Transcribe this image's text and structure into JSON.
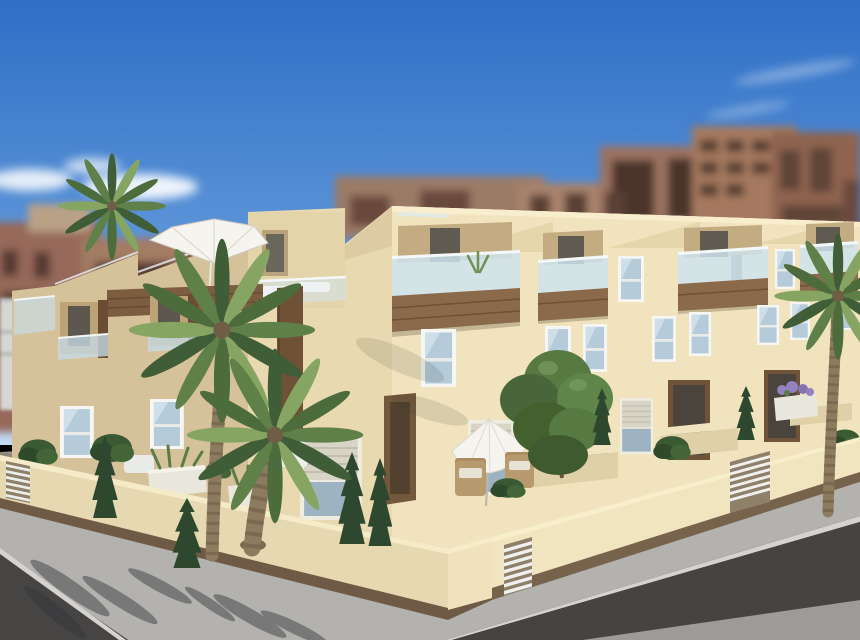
{
  "scene": {
    "type": "3D architectural rendering (photographic scene, no UI chrome or text)",
    "subject": "Modern Mediterranean cream-coloured townhouse complex viewed from a street corner on a sunny day",
    "sky": "clear blue sky, brighter toward the horizon, a few soft white clouds upper-left and faint wisps upper-right",
    "background": "out-of-focus red-brown and tan high-rise apartment blocks with dark window openings",
    "midground": "two-to-three storey cream townhouses with stepped sloped roof parapets, roof terraces, glass balustrades, dark wood balcony fascias, white-framed windows, recessed entrances, a chimney and two white parasols",
    "foreground": "cream perimeter wall with dark base band and white slatted gates, private terraces with wicker chairs and planters, street palm trees, dark cypress shrubs, grey sidewalk with palm shadows, dark asphalt roads crossing at the corner",
    "objects": {
      "palm_trees": 4,
      "cypress_trees": 6,
      "shrubs_and_planters": 8,
      "parasols": 2,
      "gates": 3,
      "chairs": 4,
      "chimneys": 1,
      "deciduous_trees": 1
    }
  },
  "colors": {
    "sky_top": "#2e6ec6",
    "sky_mid": "#5d95d8",
    "sky_horizon": "#c3d9ee",
    "cloud": "#ffffff",
    "bg_block_red": "#96695a",
    "bg_block_red2": "#8d6052",
    "bg_block_tan": "#a8826c",
    "bg_block_tan2": "#9b7260",
    "bg_window": "#543b31",
    "distant_white_building": "#d6d6d2",
    "facade_sunlit": "#f1e3bd",
    "facade_shadow": "#d5c19a",
    "facade_roof_block": "#e4d4aa",
    "facade_recess": "#c4ac82",
    "parapet_highlight": "#f8eecd",
    "balcony_wood": "#8a6a4a",
    "wood_dark": "#5e452f",
    "entry_wood": "#74583c",
    "glass_balustrade": "#cfe3ed",
    "glass_window": "#b5cbd9",
    "window_frame": "#f6f7f4",
    "window_dark": "#6b7476",
    "perimeter_wall": "#e6d8b0",
    "perimeter_wall_sunlit": "#f1e5c0",
    "wall_coping": "#f5ebc8",
    "wall_base": "#6f5a45",
    "gate_white": "#f0f1ef",
    "sidewalk": "#b3b2af",
    "road_asphalt": "#454443",
    "far_pavement": "#9c9b98",
    "shadow_gray": "#33323a",
    "terrace_ground": "#9a9283",
    "palm_green": "#5f8048",
    "palm_green_dark": "#3f5d36",
    "palm_green_light": "#86a562",
    "palm_trunk": "#8d7b5f",
    "conifer_green": "#2d482e",
    "shrub_green": "#3a5a33",
    "tree_canopy": "#567a42",
    "planter_white": "#e9e7dc",
    "flower_purple": "#9282be",
    "parasol_white": "#f5f4ee",
    "wicker_tan": "#b79a6d"
  }
}
